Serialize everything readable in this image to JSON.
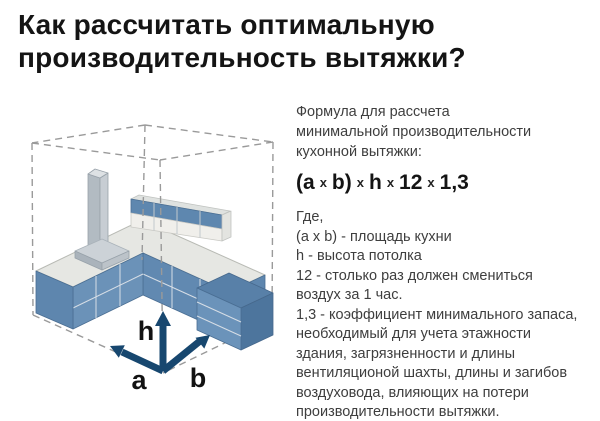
{
  "title": "Как рассчитать оптимальную\nпроизводительность вытяжки?",
  "diagram": {
    "axis_labels": {
      "height": "h",
      "width": "a",
      "depth": "b"
    },
    "colors": {
      "cabinet_blue": "#6b92b8",
      "cabinet_blue_dark": "#5e86ae",
      "countertop_gray": "#e6e7e3",
      "hood_gray": "#b2bbc2",
      "arrow_navy": "#17476f",
      "wireframe_gray": "#9a9a9a"
    }
  },
  "panel": {
    "intro": "Формула для рассчета\nминимальной производительности\nкухонной вытяжки:",
    "formula": [
      "(a",
      "x",
      "b)",
      "x",
      "h",
      "x",
      "12",
      "x",
      "1,3"
    ],
    "legend": [
      "Где,",
      "(a x b) - площадь кухни",
      "h - высота потолка",
      "12 - столько раз должен смениться\nвоздух за 1 час.",
      "1,3 - коэффициент минимального запаса,\nнеобходимый для учета этажности\nздания, загрязненности и длины\nвентиляционой шахты, длины и загибов\nвоздуховода, влияющих на потери\nпроизводительности вытяжки."
    ]
  }
}
